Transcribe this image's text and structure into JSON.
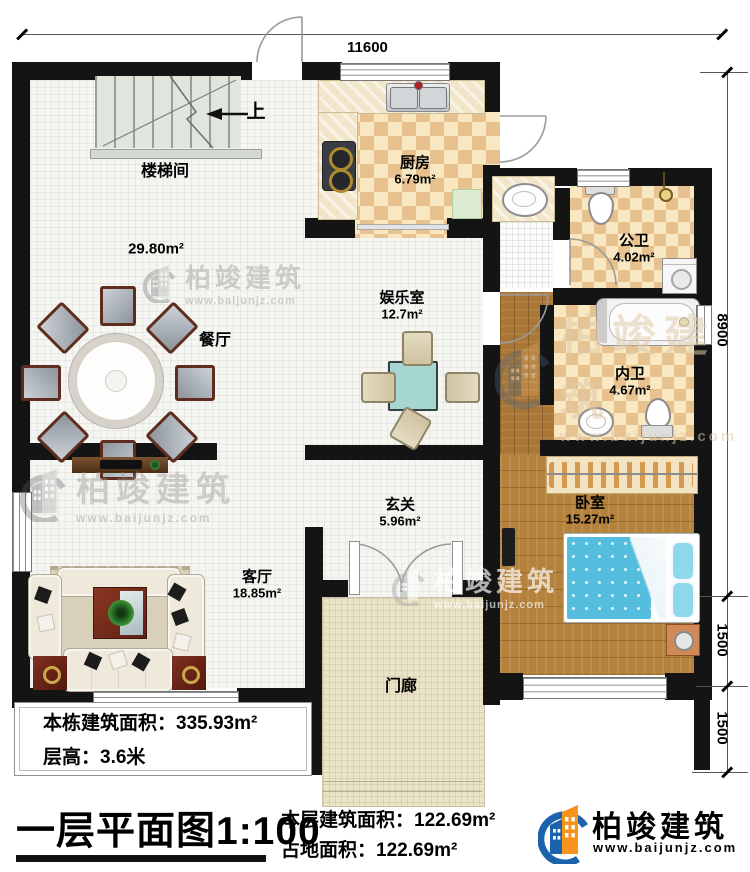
{
  "title": "一层平面图1:100",
  "dimensions": {
    "top": "11600",
    "right_total": "8900",
    "right_seg1": "1500",
    "right_seg2": "1500"
  },
  "rooms": {
    "stairwell": {
      "name": "楼梯间"
    },
    "hall": {
      "area": "29.80m²"
    },
    "kitchen": {
      "name": "厨房",
      "area": "6.79m²"
    },
    "public_bath": {
      "name": "公卫",
      "area": "4.02m²"
    },
    "inner_bath": {
      "name": "内卫",
      "area": "4.67m²"
    },
    "dining": {
      "name": "餐厅"
    },
    "entertainment": {
      "name": "娱乐室",
      "area": "12.7m²"
    },
    "foyer": {
      "name": "玄关",
      "area": "5.96m²"
    },
    "living": {
      "name": "客厅",
      "area": "18.85m²"
    },
    "bedroom": {
      "name": "卧室",
      "area": "15.27m²"
    },
    "porch": {
      "name": "门廊"
    }
  },
  "stair_direction": "上",
  "info_box": {
    "line1": "本栋建筑面积：335.93m²",
    "line2": "层高：3.6米"
  },
  "stats": {
    "line1": "本层建筑面积：122.69m²",
    "line2": "占地面积：122.69m²"
  },
  "brand": {
    "name": "柏竣建筑",
    "url": "www.baijunjz.com"
  },
  "colors": {
    "wall": "#141414",
    "accent_blue": "#1c63ad",
    "accent_orange": "#f7941d"
  }
}
